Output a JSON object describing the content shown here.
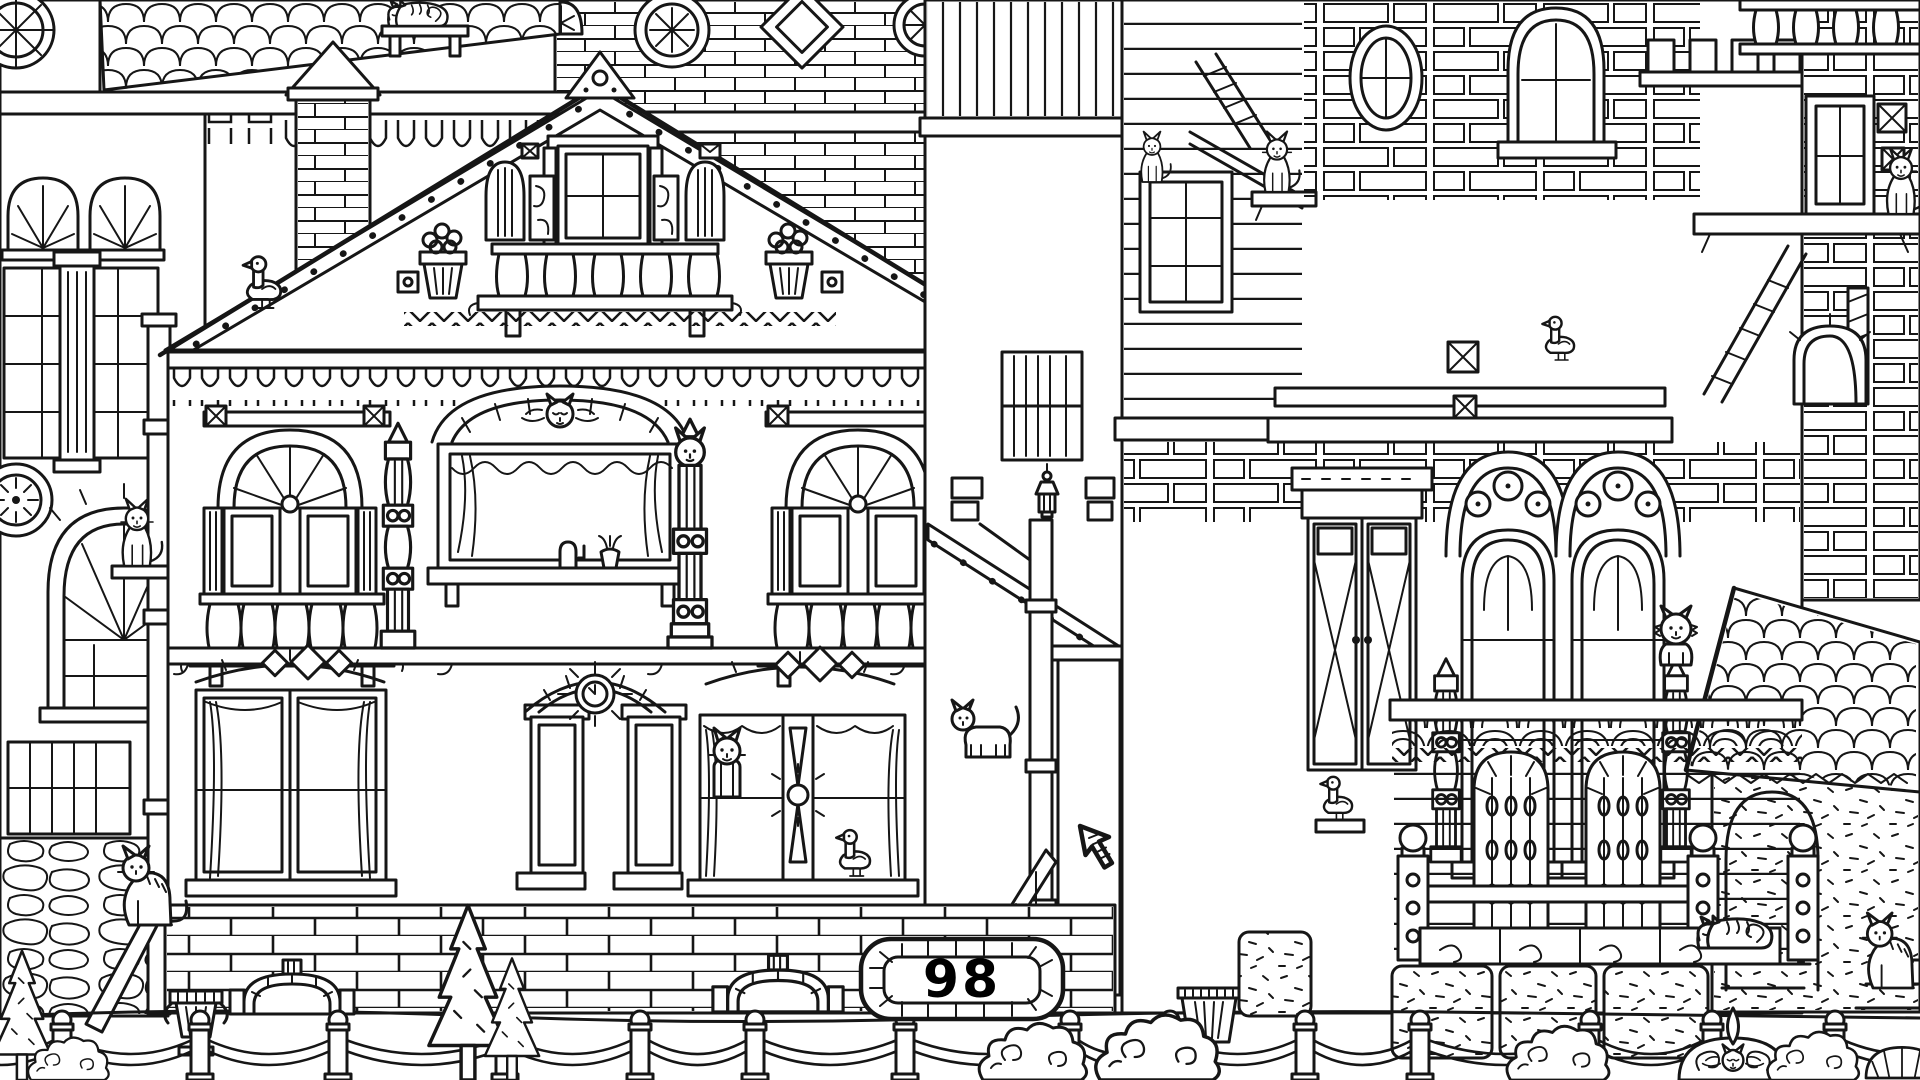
{
  "hud": {
    "counter_name": "cats-found-counter",
    "counter_value": "98"
  },
  "colors": {
    "ink": "#161616",
    "paper": "#ffffff",
    "counter_text": "#000000"
  },
  "cursor": {
    "name": "pointer-cursor",
    "x": 1080,
    "y": 826
  },
  "hidden_objects": [
    {
      "type": "cat-sleep",
      "name": "cat-sleeping-top-shelf",
      "x": 418,
      "y": 26,
      "s": 0.8
    },
    {
      "type": "cat-sit",
      "name": "cat-on-landing-rail",
      "x": 1152,
      "y": 182,
      "s": 0.6
    },
    {
      "type": "cat-sit",
      "name": "cat-on-stone-ledge",
      "x": 1277,
      "y": 192,
      "s": 0.72
    },
    {
      "type": "cat-sit",
      "name": "cat-statue-tower-ledge",
      "x": 1901,
      "y": 214,
      "s": 0.78
    },
    {
      "type": "cat-sit",
      "name": "cat-on-pole-bracket",
      "x": 137,
      "y": 566,
      "s": 0.8
    },
    {
      "type": "cat-arch",
      "name": "cat-ornament-pediment",
      "x": 560,
      "y": 416,
      "s": 1
    },
    {
      "type": "cat-totem",
      "name": "cat-carved-column",
      "x": 690,
      "y": 648,
      "s": 1.1
    },
    {
      "type": "cat-stand",
      "name": "cat-standing-alley",
      "x": 988,
      "y": 757,
      "s": 1
    },
    {
      "type": "cat-peek",
      "name": "cat-in-window",
      "x": 727,
      "y": 797,
      "s": 1
    },
    {
      "type": "duck",
      "name": "duck-in-window",
      "x": 855,
      "y": 876,
      "s": 0.85
    },
    {
      "type": "duck",
      "name": "duck-on-roof-trim",
      "x": 264,
      "y": 308,
      "s": 0.95
    },
    {
      "type": "duck",
      "name": "duck-in-arched-window",
      "x": 1560,
      "y": 360,
      "s": 0.8
    },
    {
      "type": "duck",
      "name": "duck-on-porch-ledge",
      "x": 1338,
      "y": 820,
      "s": 0.8
    },
    {
      "type": "cat-fluffy",
      "name": "cat-on-column-top",
      "x": 1676,
      "y": 665,
      "s": 1
    },
    {
      "type": "cat-sleep",
      "name": "cat-sleeping-carved-wall",
      "x": 1735,
      "y": 948,
      "s": 1
    },
    {
      "type": "cat-side",
      "name": "cat-sitting-steps-right",
      "x": 1893,
      "y": 988,
      "s": 0.95
    },
    {
      "type": "cat-side",
      "name": "cat-at-pole-base",
      "x": 150,
      "y": 925,
      "s": 1
    },
    {
      "type": "cat-arch",
      "name": "cat-face-garden-ornament",
      "x": 1733,
      "y": 1062,
      "s": 0.8
    }
  ],
  "decorations": [
    {
      "type": "lantern",
      "name": "wall-lantern",
      "x": 1047,
      "y": 464,
      "s": 1,
      "layer": "back"
    },
    {
      "type": "urn",
      "name": "stone-urn",
      "x": 196,
      "y": 1055,
      "s": 1,
      "layer": "back"
    },
    {
      "type": "arch-decor",
      "name": "garden-arch-left",
      "x": 292,
      "y": 1014,
      "s": 1,
      "layer": "back"
    },
    {
      "type": "arch-decor",
      "name": "garden-arch-center",
      "x": 778,
      "y": 1012,
      "s": 1.05,
      "layer": "back"
    },
    {
      "type": "planter",
      "name": "striped-planter",
      "x": 1209,
      "y": 1042,
      "s": 1,
      "layer": "back"
    },
    {
      "type": "block",
      "name": "speckled-stone-block",
      "x": 1275,
      "y": 1016,
      "s": 1,
      "layer": "back"
    },
    {
      "type": "tree",
      "name": "pine-tree-left",
      "x": 22,
      "y": 1080,
      "s": 0.85,
      "layer": "front"
    },
    {
      "type": "bush",
      "name": "bush-far-left",
      "x": 70,
      "y": 1080,
      "s": 0.75,
      "layer": "front"
    },
    {
      "type": "tree",
      "name": "pine-tree-mid",
      "x": 468,
      "y": 1080,
      "s": 1.15,
      "layer": "front"
    },
    {
      "type": "tree",
      "name": "pine-tree-mid-small",
      "x": 512,
      "y": 1080,
      "s": 0.8,
      "layer": "front"
    },
    {
      "type": "bush",
      "name": "bush-center-left",
      "x": 1035,
      "y": 1080,
      "s": 1,
      "layer": "front"
    },
    {
      "type": "bush",
      "name": "bush-center-right",
      "x": 1160,
      "y": 1080,
      "s": 1.15,
      "layer": "front"
    },
    {
      "type": "bush",
      "name": "bush-right",
      "x": 1560,
      "y": 1080,
      "s": 0.95,
      "layer": "front"
    },
    {
      "type": "fleur",
      "name": "fan-garden-ornament",
      "x": 1733,
      "y": 1080,
      "s": 1,
      "layer": "front"
    },
    {
      "type": "bush",
      "name": "bush-far-right",
      "x": 1815,
      "y": 1080,
      "s": 0.85,
      "layer": "front"
    },
    {
      "type": "dome",
      "name": "striped-dome-ornament",
      "x": 1902,
      "y": 1078,
      "s": 0.9,
      "layer": "front"
    }
  ],
  "fence": {
    "posts": [
      62,
      200,
      338,
      505,
      640,
      755,
      905,
      1070,
      1170,
      1305,
      1420,
      1590,
      1712,
      1835
    ]
  }
}
